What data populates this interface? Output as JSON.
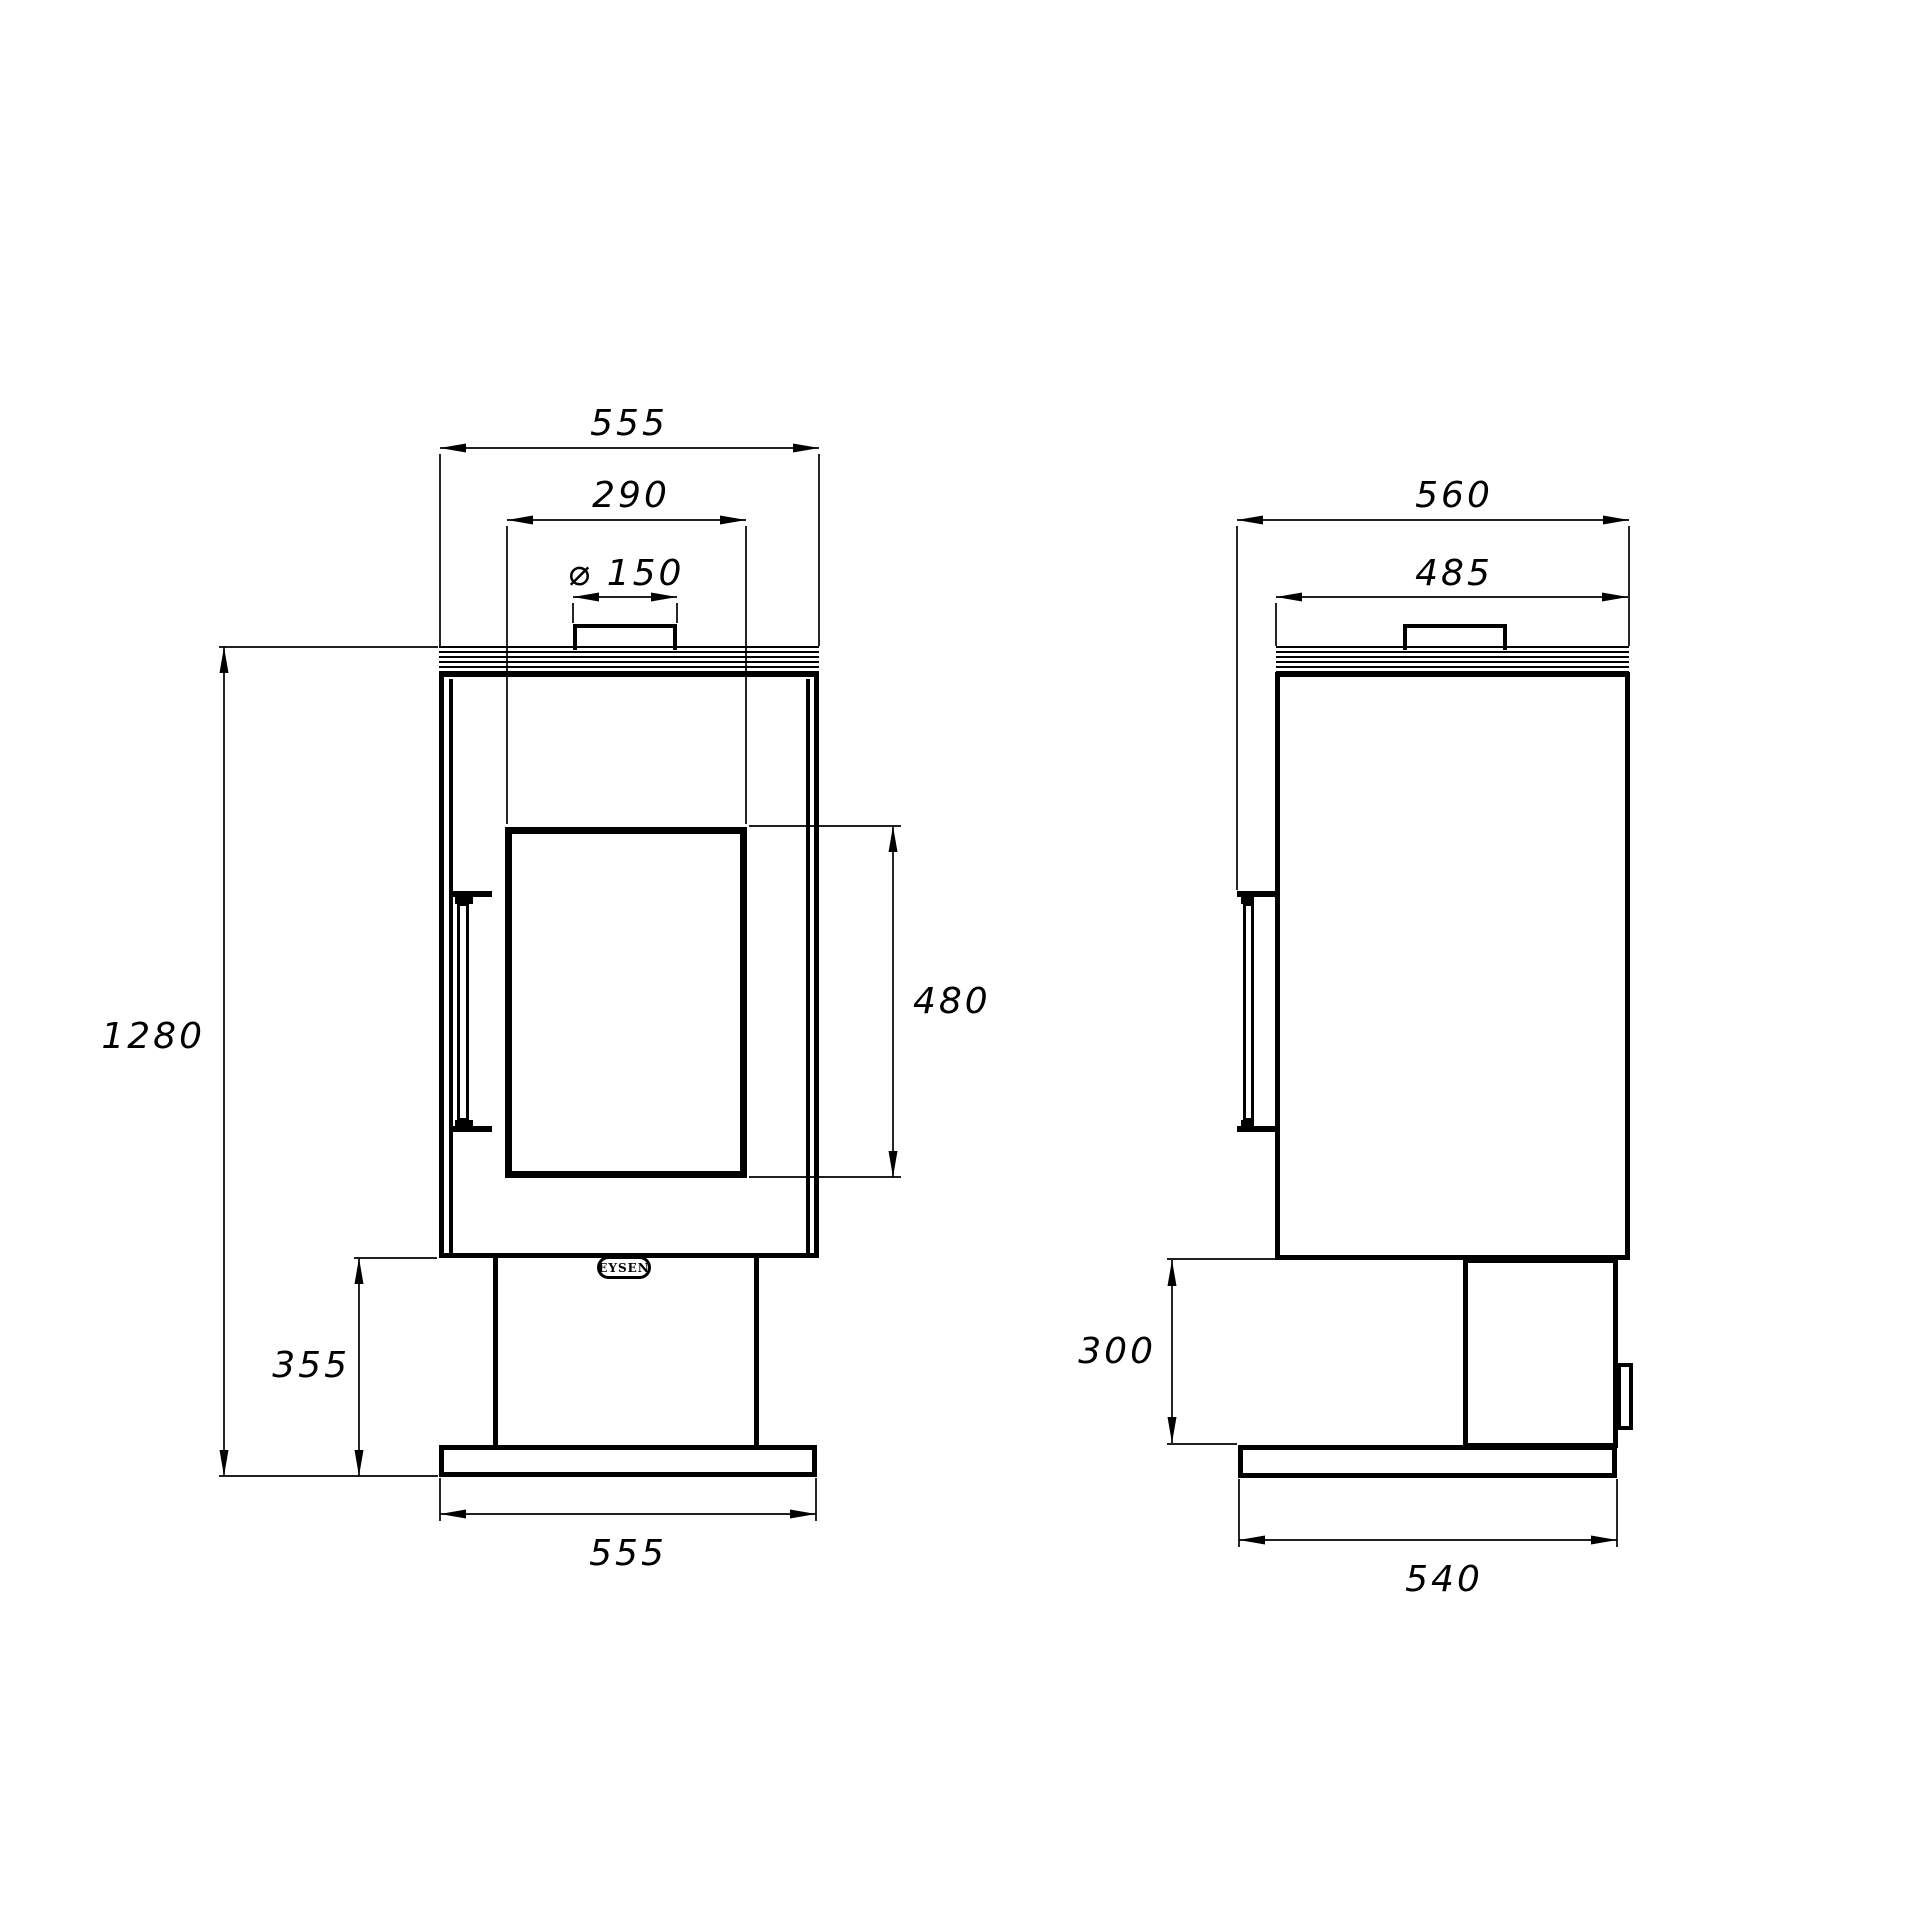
{
  "drawing": {
    "brand_label": "EYSEN",
    "line_color": "#000000",
    "background": "#ffffff",
    "dimensions": {
      "front_top_width": "555",
      "front_glass_width": "290",
      "front_flue_diameter": "⌀ 150",
      "front_overall_height": "1280",
      "front_glass_height": "480",
      "front_pedestal_height": "355",
      "front_base_width": "555",
      "side_overall_depth": "560",
      "side_top_depth": "485",
      "side_pedestal_height": "300",
      "side_base_depth": "540"
    }
  }
}
